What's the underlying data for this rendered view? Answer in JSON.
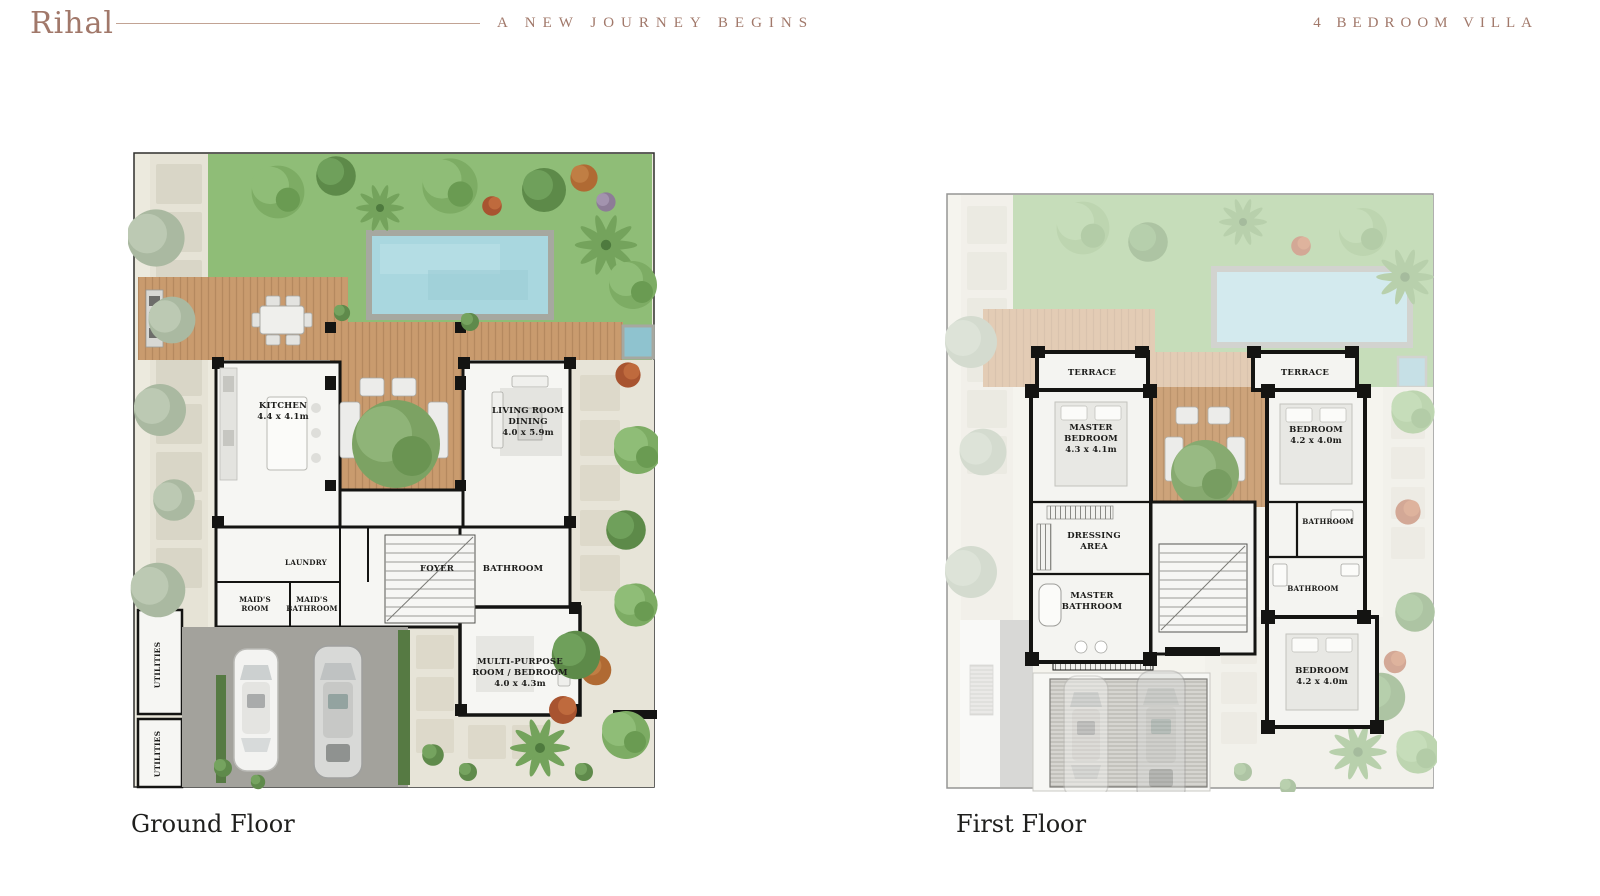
{
  "header": {
    "brand": "Rihal",
    "tagline": "A NEW JOURNEY BEGINS",
    "plan_type": "4 BEDROOM VILLA"
  },
  "colors": {
    "brand_text": "#a1786a",
    "wall": "#141412",
    "lawn": "#8fbd77",
    "pool_water": "#a9d7df",
    "deck": "#c99b6e",
    "label_text": "#1c1c1a"
  },
  "ground_floor": {
    "caption": "Ground Floor",
    "rooms": {
      "kitchen": {
        "line1": "KITCHEN",
        "dims": "4.4 x 4.1m"
      },
      "living": {
        "line1": "LIVING ROOM",
        "line2": "DINING",
        "dims": "4.0 x 5.9m"
      },
      "laundry": {
        "line1": "LAUNDRY"
      },
      "maids_room": {
        "line1": "MAID'S",
        "line2": "ROOM"
      },
      "maids_bathroom": {
        "line1": "MAID'S",
        "line2": "BATHROOM"
      },
      "foyer": {
        "line1": "FOYER"
      },
      "bathroom": {
        "line1": "BATHROOM"
      },
      "multipurpose": {
        "line1": "MULTI-PURPOSE",
        "line2": "ROOM / BEDROOM",
        "dims": "4.0 x 4.3m"
      },
      "utilities_1": {
        "line1": "UTILITIES"
      },
      "utilities_2": {
        "line1": "UTILITIES"
      }
    }
  },
  "first_floor": {
    "caption": "First Floor",
    "rooms": {
      "terrace_left": {
        "line1": "TERRACE"
      },
      "terrace_right": {
        "line1": "TERRACE"
      },
      "master_bedroom": {
        "line1": "MASTER",
        "line2": "BEDROOM",
        "dims": "4.3 x 4.1m"
      },
      "bedroom_top": {
        "line1": "BEDROOM",
        "dims": "4.2 x 4.0m"
      },
      "dressing_area": {
        "line1": "DRESSING",
        "line2": "AREA"
      },
      "master_bathroom": {
        "line1": "MASTER",
        "line2": "BATHROOM"
      },
      "bathroom_top": {
        "line1": "BATHROOM"
      },
      "bathroom_mid": {
        "line1": "BATHROOM"
      },
      "bedroom_bottom": {
        "line1": "BEDROOM",
        "dims": "4.2 x 4.0m"
      }
    }
  }
}
